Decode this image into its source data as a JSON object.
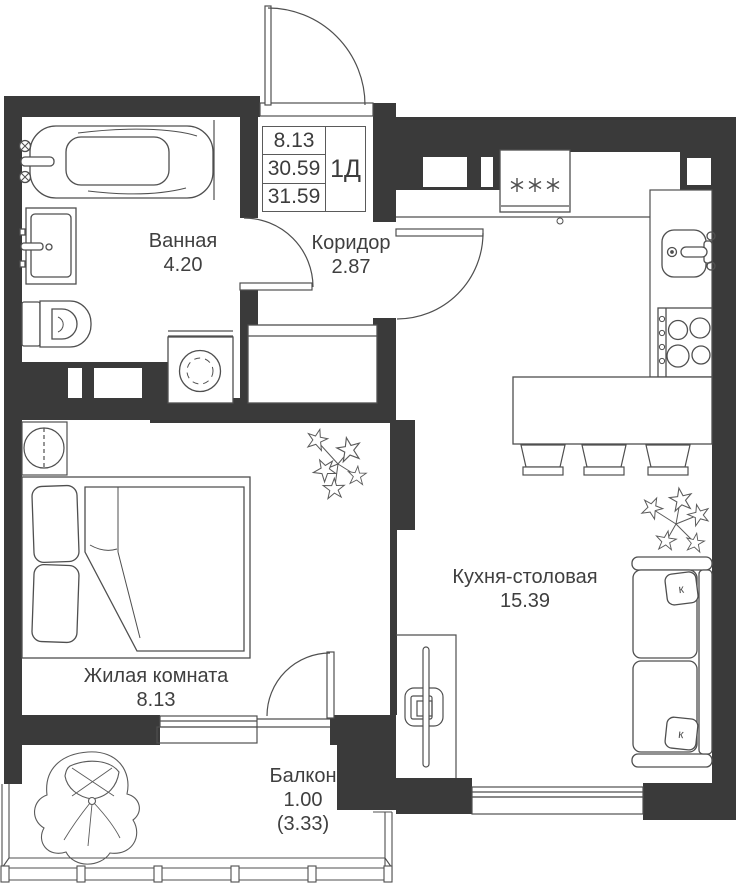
{
  "plan": {
    "rooms": [
      {
        "id": "bathroom",
        "name": "Ванная",
        "area": "4.20"
      },
      {
        "id": "corridor",
        "name": "Коридор",
        "area": "2.87"
      },
      {
        "id": "kitchen",
        "name": "Кухня-столовая",
        "area": "15.39"
      },
      {
        "id": "living",
        "name": "Жилая комната",
        "area": "8.13"
      },
      {
        "id": "balcony",
        "name": "Балкон",
        "area": "1.00",
        "area_coeff": "(3.33)"
      }
    ],
    "title_block": {
      "living_area": "8.13",
      "area_without_balcony": "30.59",
      "total_area": "31.59",
      "unit_type": "1Д"
    },
    "symbols": {
      "freezer_stars": "✳✳✳",
      "pillow_letter": "к"
    },
    "colors": {
      "wall": "#3a3a3a",
      "line": "#4f4f4f",
      "text": "#3f3f3f",
      "bg": "#ffffff"
    }
  }
}
